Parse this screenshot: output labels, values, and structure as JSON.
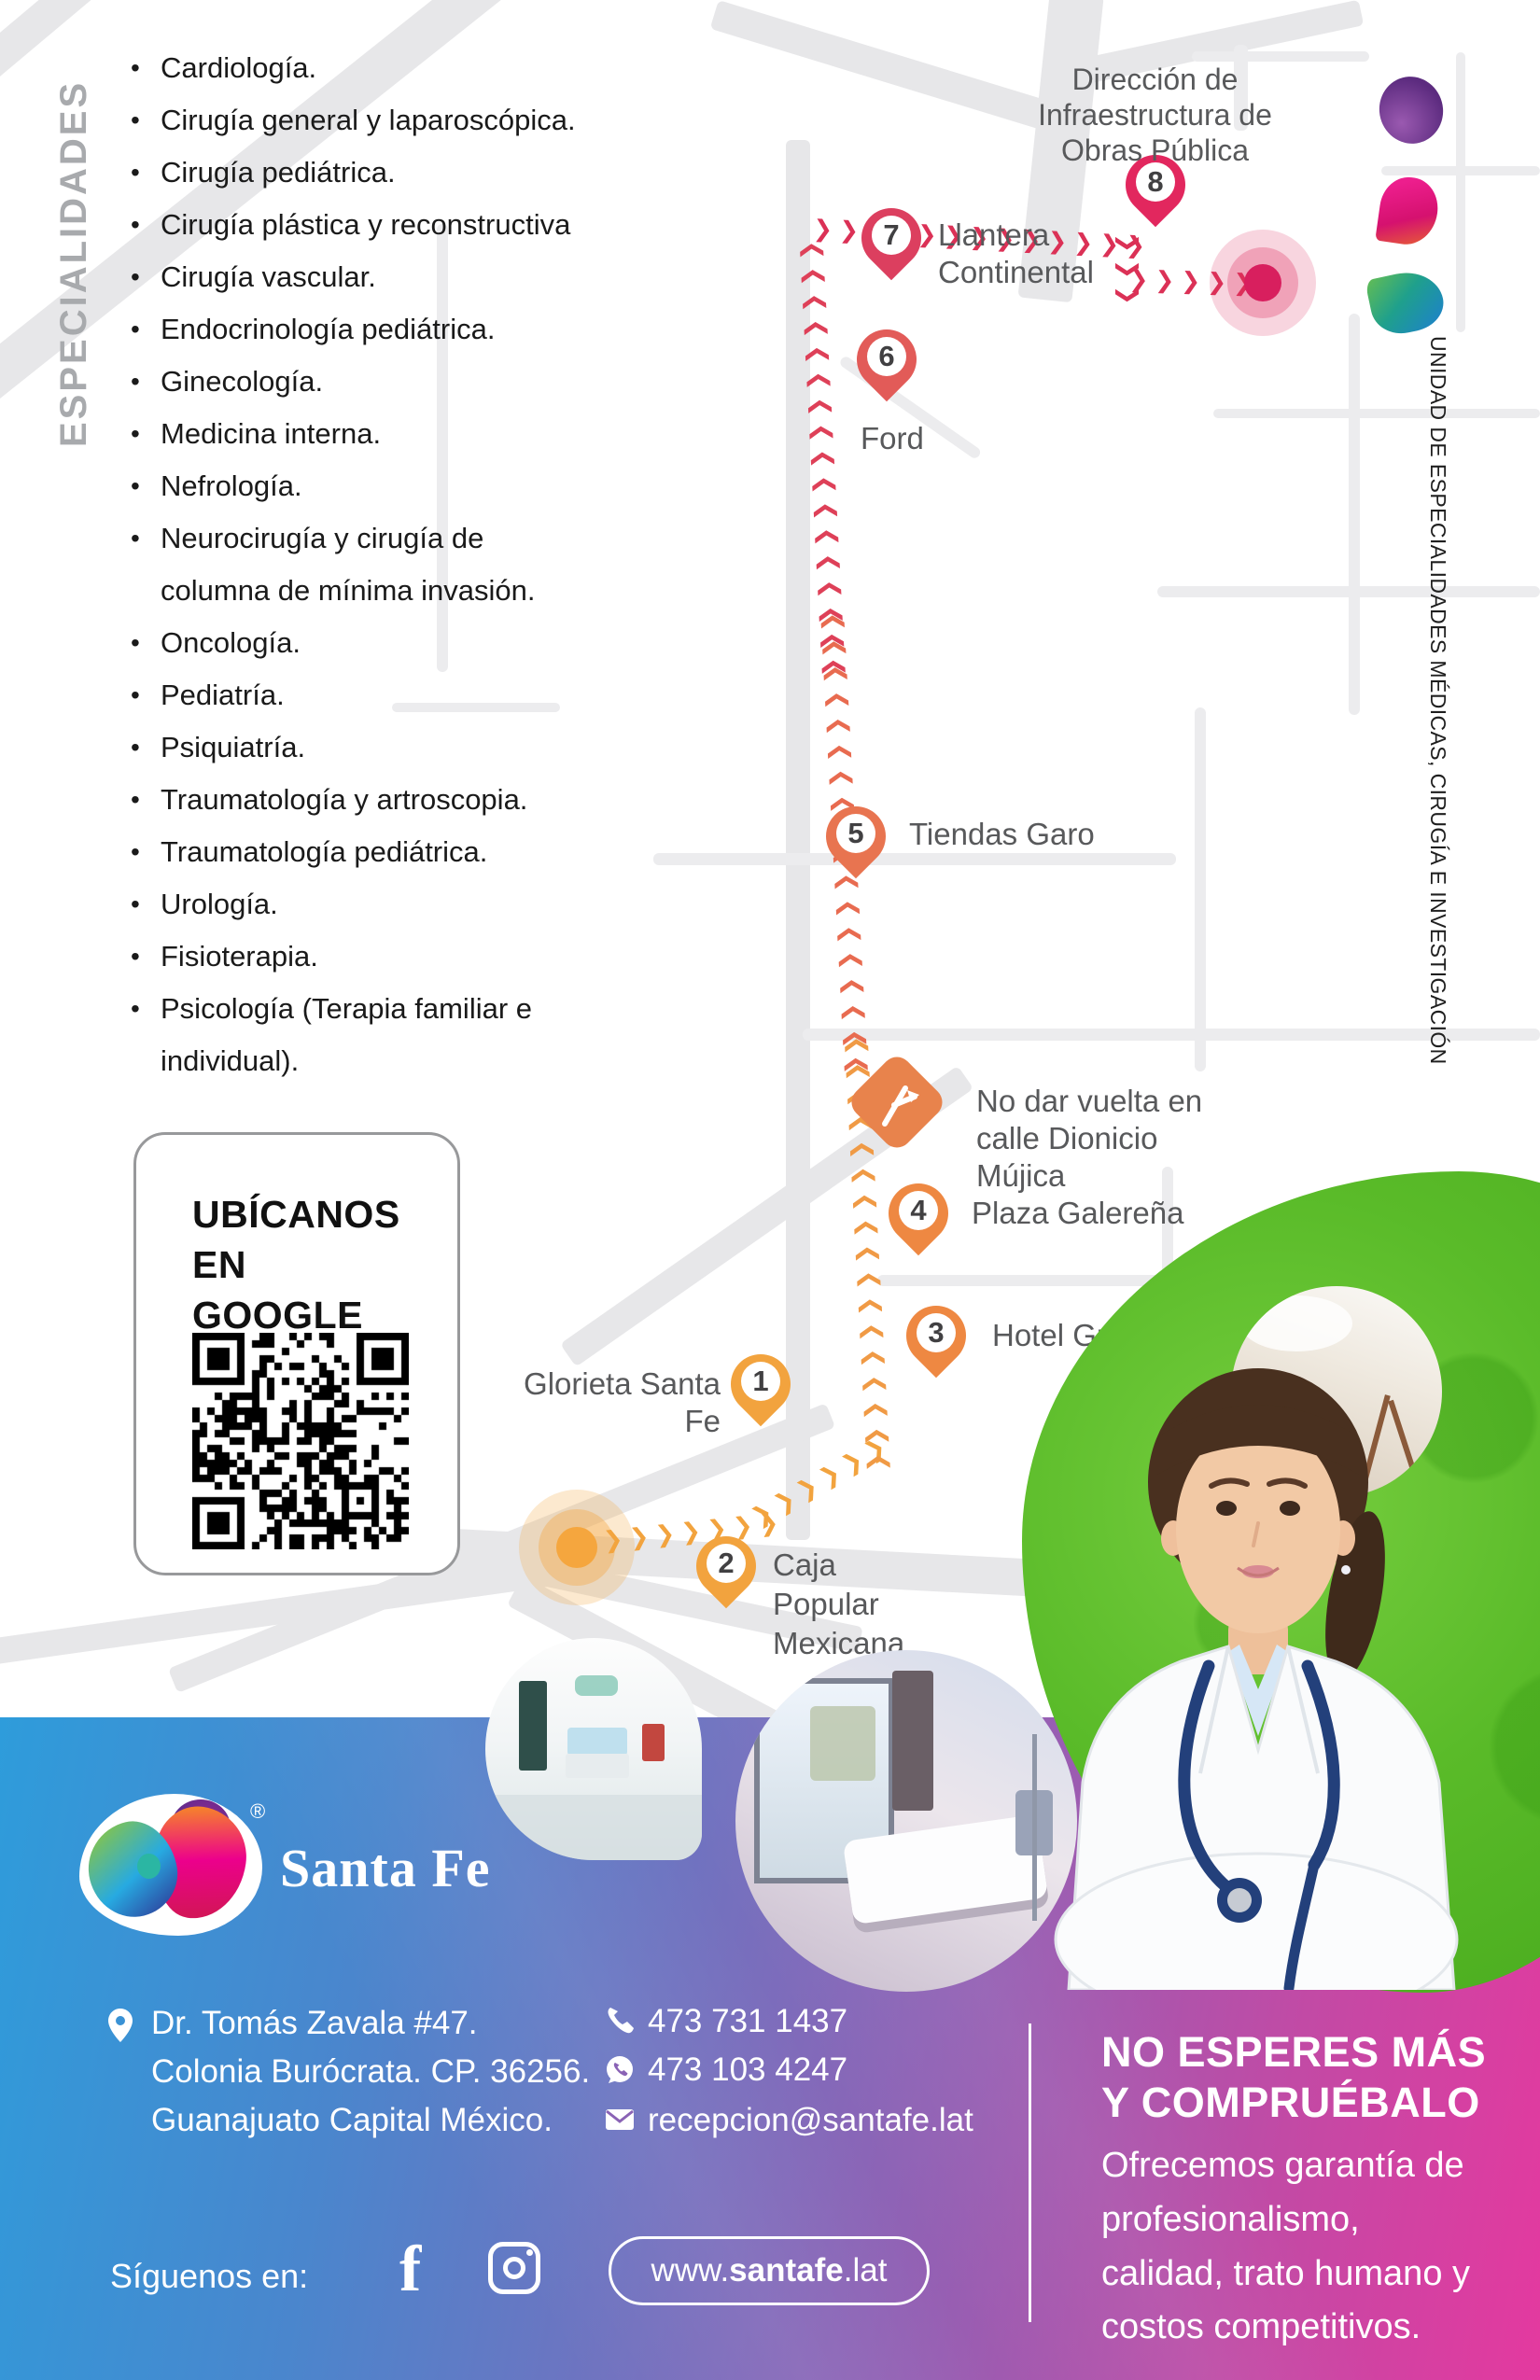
{
  "specialties": {
    "sidebar_label": "ESPECIALIDADES",
    "items": [
      "Cardiología.",
      "Cirugía general y laparoscópica.",
      "Cirugía pediátrica.",
      "Cirugía plástica y reconstructiva",
      "Cirugía vascular.",
      "Endocrinología pediátrica.",
      "Ginecología.",
      "Medicina interna.",
      "Nefrología.",
      "Neurocirugía y cirugía de\ncolumna de mínima invasión.",
      "Oncología.",
      "Pediatría.",
      "Psiquiatría.",
      "Traumatología y artroscopia.",
      "Traumatología pediátrica.",
      "Urología.",
      "Fisioterapia.",
      "Psicología (Terapia familiar e\nindividual)."
    ]
  },
  "map": {
    "side_caption": "UNIDAD DE ESPECIALIDADES MÉDICAS, CIRUGÍA E INVESTIGACIÓN",
    "warning": "No dar vuelta en calle Dionicio Mújica",
    "markers": [
      {
        "number": "1",
        "label": "Glorieta Santa Fe",
        "color": "#F2A33E"
      },
      {
        "number": "2",
        "label": "Caja Popular Mexicana",
        "color": "#F2A33E"
      },
      {
        "number": "3",
        "label": "Hotel Gran Plaza",
        "color": "#EE8842"
      },
      {
        "number": "4",
        "label": "Plaza Galereña",
        "color": "#EE8842"
      },
      {
        "number": "5",
        "label": "Tiendas Garo",
        "color": "#E87450"
      },
      {
        "number": "6",
        "label": "Ford",
        "color": "#E25B58"
      },
      {
        "number": "7",
        "label": "Llantera Continental",
        "color": "#DC3F5F"
      },
      {
        "number": "8",
        "label": "Dirección de Infraestructura de Obras Pública",
        "color": "#E2275E"
      }
    ]
  },
  "qr_card": {
    "title": "UBÍCANOS EN GOOGLE MAPS"
  },
  "footer": {
    "brand": "Santa Fe",
    "registered": "®",
    "address": "Dr. Tomás Zavala #47.\nColonia Burócrata. CP. 36256.\nGuanajuato Capital México.",
    "phone": "473 731 1437",
    "whatsapp": "473 103 4247",
    "email": "recepcion@santafe.lat",
    "promo_title": "NO ESPERES MÁS Y COMPRUÉBALO",
    "promo_body": "Ofrecemos garantía de profesionalismo, calidad, trato humano y costos competitivos.",
    "follow_label": "Síguenos en:",
    "website": {
      "prefix": "www.",
      "bold": "santafe",
      "suffix": ".lat"
    }
  },
  "colors": {
    "route_start": "#F2A33E",
    "route_end": "#DB3156",
    "band_blue": "#2E9CDB",
    "band_pink": "#E4399F",
    "sign_orange": "#E8834C"
  }
}
